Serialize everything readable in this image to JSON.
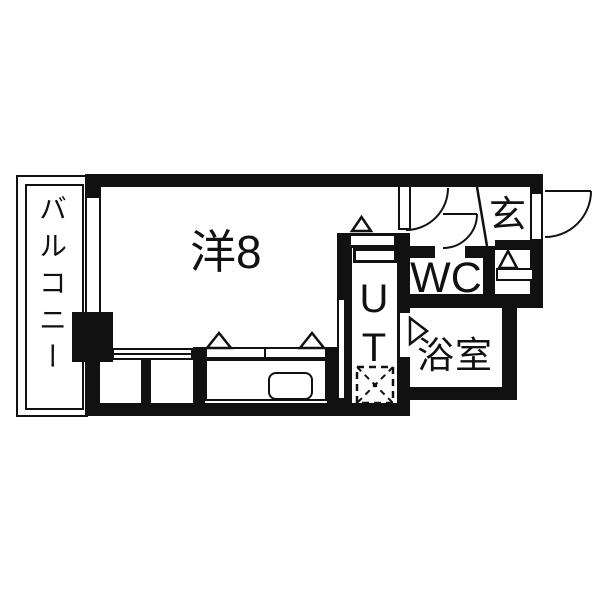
{
  "plan": {
    "title": "apartment-floor-plan",
    "rooms": {
      "balcony": {
        "label": "バルコニー"
      },
      "main_room": {
        "label": "洋8"
      },
      "utility": {
        "label": "UT"
      },
      "wc": {
        "label": "WC"
      },
      "bathroom": {
        "label": "浴室"
      },
      "entrance": {
        "label": "玄"
      }
    },
    "colors": {
      "wall": "#111111",
      "background": "#ffffff"
    }
  }
}
